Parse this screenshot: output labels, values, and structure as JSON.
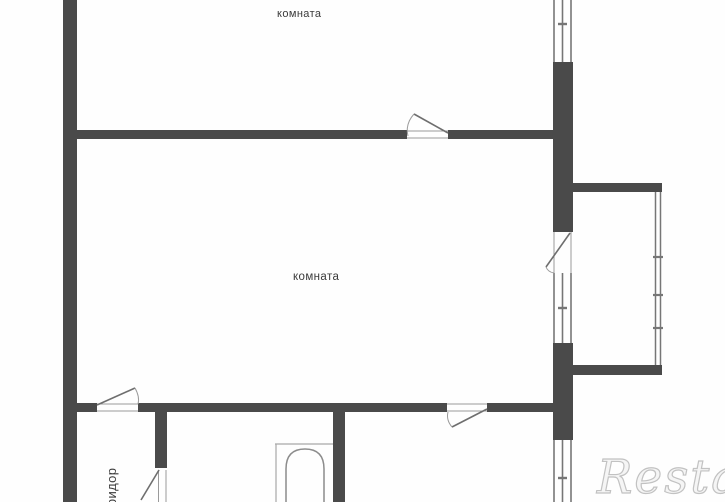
{
  "labels": {
    "room_top": "комната",
    "room_middle": "комната",
    "corridor": "коридор"
  },
  "watermark": {
    "text": "Restate"
  },
  "colors": {
    "wall": "#4a4a4a",
    "thin_line": "#767676",
    "door_line": "#6e6e6e",
    "fixture_line": "#8c8c8c",
    "label_text": "#3b3b3b",
    "watermark_outline": "#c2c2c2",
    "background": "#fefefe"
  }
}
